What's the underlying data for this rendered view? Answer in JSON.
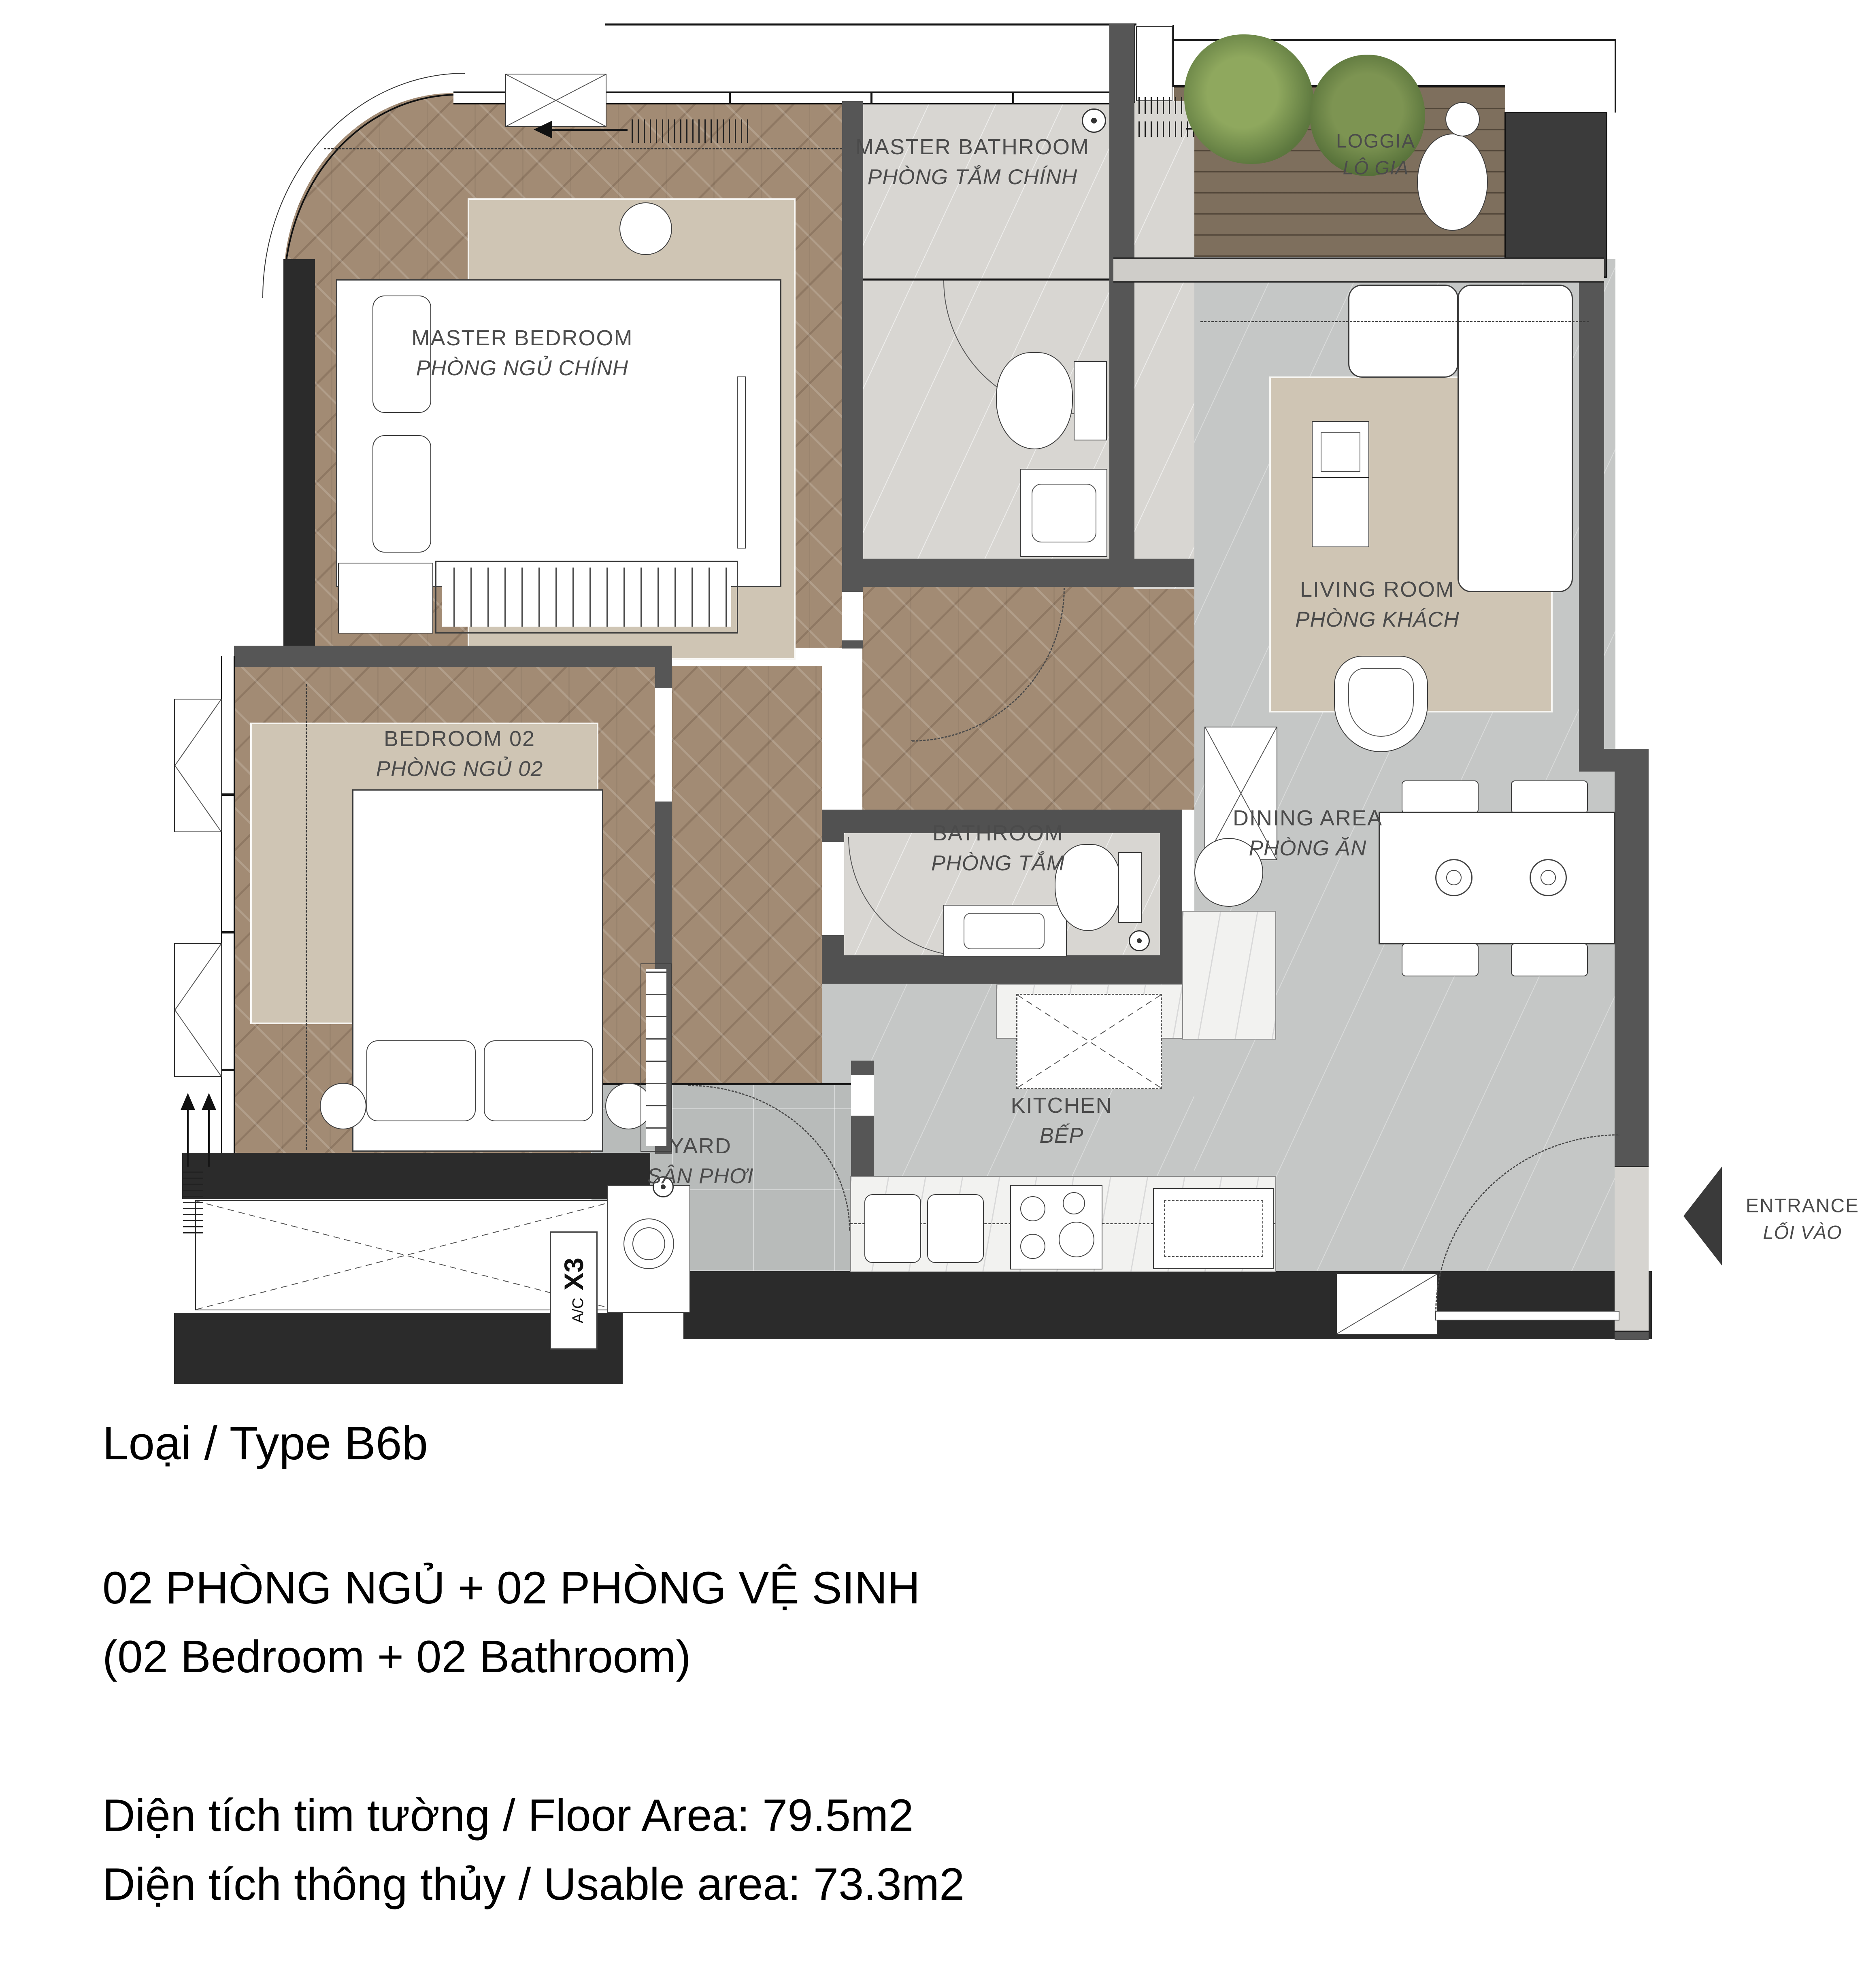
{
  "plan": {
    "rooms": {
      "master_bedroom": {
        "en": "MASTER BEDROOM",
        "vi": "PHÒNG NGỦ CHÍNH"
      },
      "master_bathroom": {
        "en": "MASTER BATHROOM",
        "vi": "PHÒNG TẮM CHÍNH"
      },
      "loggia": {
        "en": "LOGGIA",
        "vi": "LÔ GIA"
      },
      "living_room": {
        "en": "LIVING ROOM",
        "vi": "PHÒNG KHÁCH"
      },
      "bedroom_02": {
        "en": "BEDROOM 02",
        "vi": "PHÒNG NGỦ 02"
      },
      "bathroom": {
        "en": "BATHROOM",
        "vi": "PHÒNG TẮM"
      },
      "dining_area": {
        "en": "DINING AREA",
        "vi": "PHÒNG ĂN"
      },
      "kitchen": {
        "en": "KITCHEN",
        "vi": "BẾP"
      },
      "yard": {
        "en": "YARD",
        "vi": "SÂN PHƠI"
      },
      "entrance": {
        "en": "ENTRANCE",
        "vi": "LỐI VÀO"
      }
    },
    "annotations": {
      "ac": "A/C",
      "x3": "X3"
    }
  },
  "info": {
    "type_label": "Loại / Type B6b",
    "config_vi": "02 PHÒNG NGỦ + 02 PHÒNG VỆ SINH",
    "config_en": "(02 Bedroom + 02 Bathroom)",
    "floor_area": "Diện tích tim tường / Floor Area: 79.5m2",
    "usable_area": "Diện tích thông thủy / Usable area: 73.3m2"
  },
  "colors": {
    "wall_dark": "#2b2b2b",
    "wall": "#565656",
    "wood_floor": "#a28b74",
    "deck": "#7e6f5d",
    "marble": "#d8d6d2",
    "floor_gray": "#c5c7c6",
    "yard_floor": "#b8bbba",
    "counter_white": "#f2f2f0",
    "rug": "#cfc5b4",
    "label_gray": "#4b4b4b",
    "text_black": "#000000"
  }
}
